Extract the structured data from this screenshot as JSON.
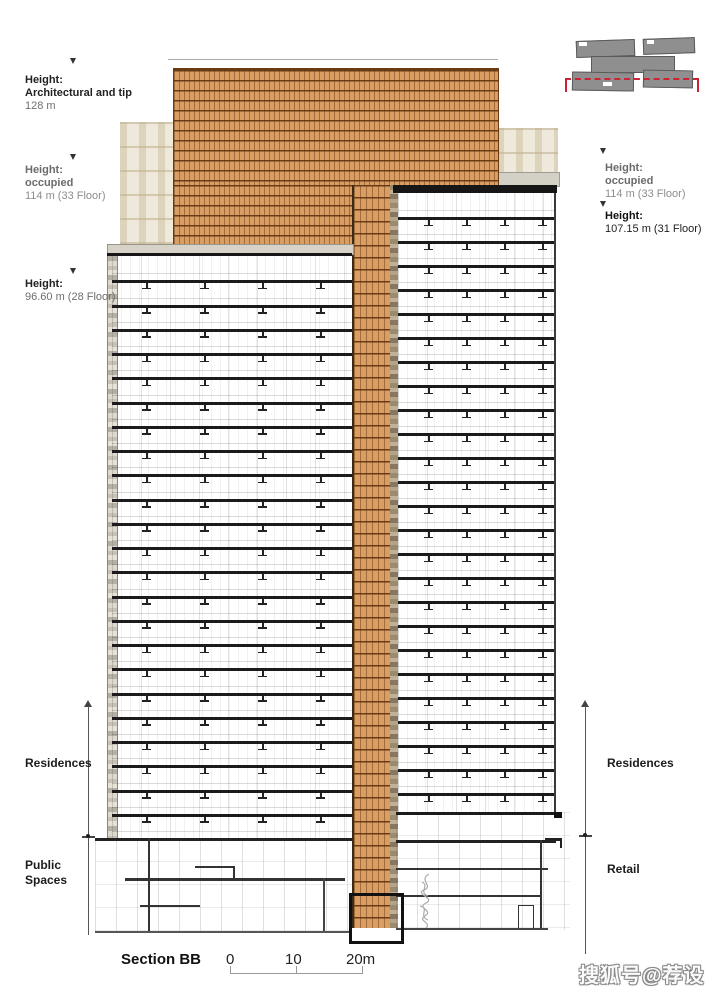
{
  "title": {
    "section_label": "Section BB"
  },
  "heights_left": [
    {
      "label": "Height:",
      "sub": "Architectural and tip",
      "value": "128 m"
    },
    {
      "label": "Height:",
      "sub": "occupied",
      "value": "114 m (33 Floor)"
    },
    {
      "label": "Height:",
      "sub": "",
      "value": "96.60 m (28 Floor)"
    }
  ],
  "heights_right": [
    {
      "label": "Height:",
      "sub": "occupied",
      "value": "114 m (33 Floor)"
    },
    {
      "label": "Height:",
      "sub": "",
      "value": "107.15 m (31 Floor)"
    }
  ],
  "zones": {
    "left_upper": "Residences",
    "left_lower": "Public Spaces",
    "right_upper": "Residences",
    "right_lower": "Retail"
  },
  "scale_bar": {
    "tick0": "0",
    "tick1": "10",
    "tick2": "20m"
  },
  "watermark": "搜狐号@荐设",
  "colors": {
    "brick": "#d89a5f",
    "section_line_red": "#cc2233",
    "slab": "#1b1b1b"
  }
}
